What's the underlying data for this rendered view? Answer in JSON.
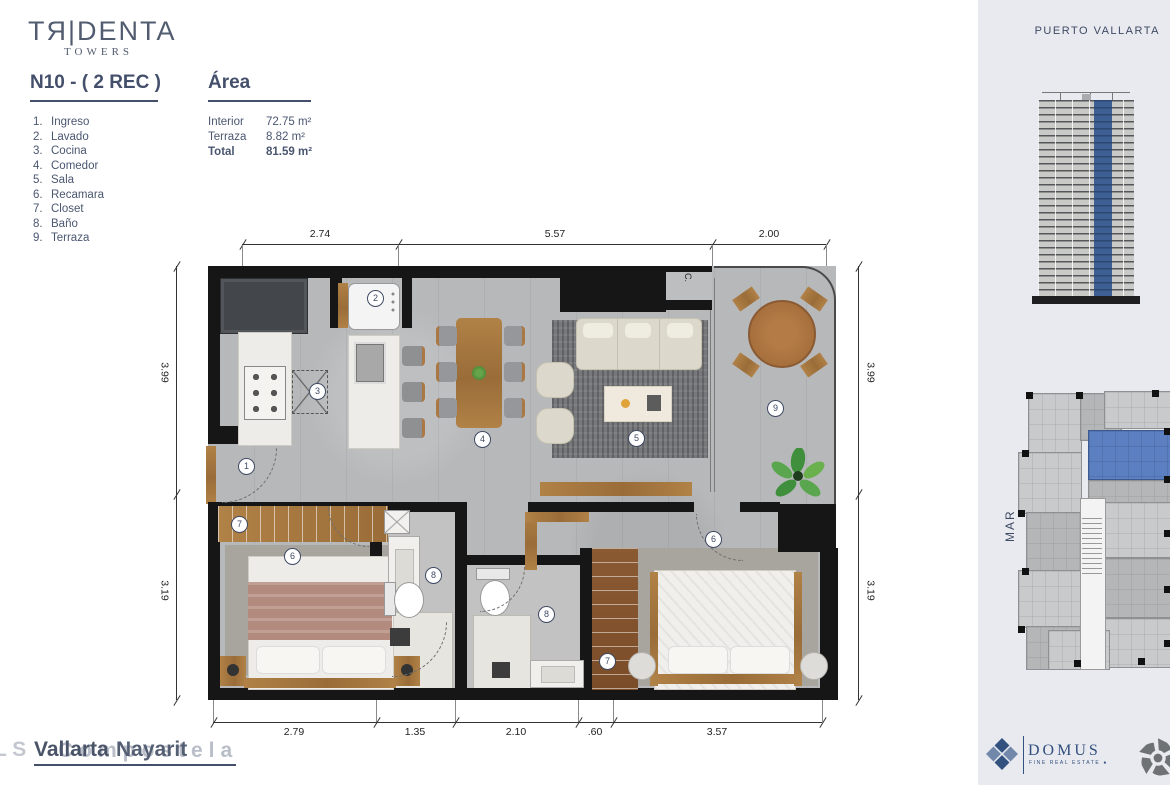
{
  "brand": {
    "logo_main": "TЯ|DENTA",
    "logo_sub": "TOWERS"
  },
  "unit": {
    "title": "N10 - ( 2 REC )"
  },
  "legend": {
    "items": [
      {
        "num": "1.",
        "label": "Ingreso"
      },
      {
        "num": "2.",
        "label": "Lavado"
      },
      {
        "num": "3.",
        "label": "Cocina"
      },
      {
        "num": "4.",
        "label": "Comedor"
      },
      {
        "num": "5.",
        "label": "Sala"
      },
      {
        "num": "6.",
        "label": "Recamara"
      },
      {
        "num": "7.",
        "label": "Closet"
      },
      {
        "num": "8.",
        "label": "Baño"
      },
      {
        "num": "9.",
        "label": "Terraza"
      }
    ]
  },
  "area": {
    "title": "Área",
    "rows": [
      {
        "label": "Interior",
        "value": "72.75 m²"
      },
      {
        "label": "Terraza",
        "value": "8.82 m²"
      },
      {
        "label": "Total",
        "value": "81.59 m²"
      }
    ]
  },
  "plan": {
    "dims_top": [
      "2.74",
      "5.57",
      "2.00"
    ],
    "dims_bottom": [
      "2.79",
      "1.35",
      "2.10",
      ".60",
      "3.57"
    ],
    "dims_left": [
      "3.99",
      "3.19"
    ],
    "dims_right": [
      "3.99",
      "3.19"
    ],
    "closet_label": "C.",
    "badges": [
      {
        "num": "1",
        "room": "ingreso"
      },
      {
        "num": "2",
        "room": "lavado"
      },
      {
        "num": "3",
        "room": "cocina"
      },
      {
        "num": "4",
        "room": "comedor"
      },
      {
        "num": "5",
        "room": "sala"
      },
      {
        "num": "6",
        "room": "recamara-1"
      },
      {
        "num": "7",
        "room": "closet-1"
      },
      {
        "num": "8",
        "room": "bano-1"
      },
      {
        "num": "9",
        "room": "terraza"
      },
      {
        "num": "6",
        "room": "recamara-2"
      },
      {
        "num": "7",
        "room": "closet-2"
      },
      {
        "num": "8",
        "room": "bano-2"
      }
    ]
  },
  "sidebar": {
    "location": "PUERTO VALLARTA",
    "sea_label": "MAR"
  },
  "footer": {
    "overlap_layers": [
      "L S",
      "Vallarta",
      "Nayarit",
      "Compostela"
    ]
  },
  "partners": {
    "domus_name": "DOMUS",
    "domus_tagline": "FINE REAL ESTATE   ●"
  },
  "colors": {
    "navy": "#3f4a63",
    "accent_blue": "#5b7fc0",
    "wall": "#161616",
    "floor": "#b7b8ba",
    "sidebar_bg": "#e8eaf0",
    "wood": "#a97845"
  }
}
